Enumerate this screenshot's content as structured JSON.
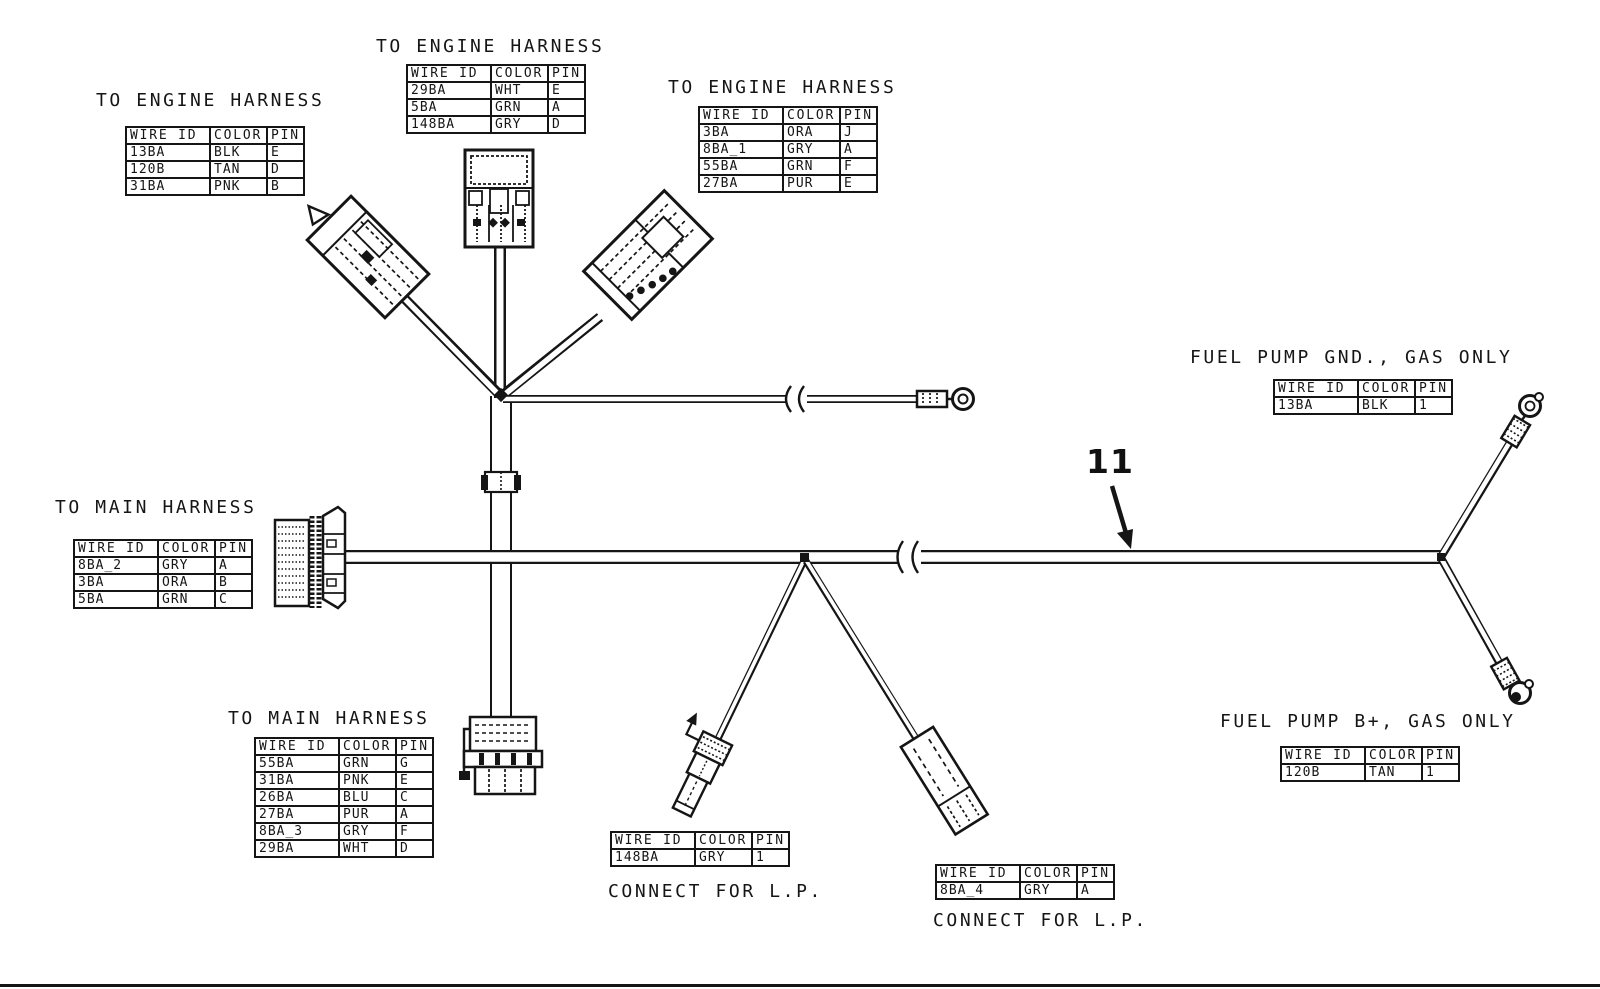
{
  "diagram": {
    "table_headers": [
      "WIRE ID",
      "COLOR",
      "PIN"
    ],
    "tables": [
      {
        "id": "engine-harness-top-left",
        "title": "TO ENGINE HARNESS",
        "rows": [
          [
            "13BA",
            "BLK",
            "E"
          ],
          [
            "120B",
            "TAN",
            "D"
          ],
          [
            "31BA",
            "PNK",
            "B"
          ]
        ]
      },
      {
        "id": "engine-harness-top-center",
        "title": "TO ENGINE HARNESS",
        "rows": [
          [
            "29BA",
            "WHT",
            "E"
          ],
          [
            "5BA",
            "GRN",
            "A"
          ],
          [
            "148BA",
            "GRY",
            "D"
          ]
        ]
      },
      {
        "id": "engine-harness-top-right",
        "title": "TO ENGINE HARNESS",
        "rows": [
          [
            "3BA",
            "ORA",
            "J"
          ],
          [
            "8BA_1",
            "GRY",
            "A"
          ],
          [
            "55BA",
            "GRN",
            "F"
          ],
          [
            "27BA",
            "PUR",
            "E"
          ]
        ]
      },
      {
        "id": "main-harness-left",
        "title": "TO MAIN HARNESS",
        "rows": [
          [
            "8BA_2",
            "GRY",
            "A"
          ],
          [
            "3BA",
            "ORA",
            "B"
          ],
          [
            "5BA",
            "GRN",
            "C"
          ]
        ]
      },
      {
        "id": "main-harness-bottom",
        "title": "TO MAIN HARNESS",
        "rows": [
          [
            "55BA",
            "GRN",
            "G"
          ],
          [
            "31BA",
            "PNK",
            "E"
          ],
          [
            "26BA",
            "BLU",
            "C"
          ],
          [
            "27BA",
            "PUR",
            "A"
          ],
          [
            "8BA_3",
            "GRY",
            "F"
          ],
          [
            "29BA",
            "WHT",
            "D"
          ]
        ]
      },
      {
        "id": "fuel-pump-gnd",
        "title": "FUEL PUMP GND., GAS ONLY",
        "rows": [
          [
            "13BA",
            "BLK",
            "1"
          ]
        ]
      },
      {
        "id": "fuel-pump-b-plus",
        "title": "FUEL PUMP B+, GAS ONLY",
        "rows": [
          [
            "120B",
            "TAN",
            "1"
          ]
        ]
      },
      {
        "id": "connect-for-lp-left",
        "title": "CONNECT FOR L.P.",
        "rows": [
          [
            "148BA",
            "GRY",
            "1"
          ]
        ]
      },
      {
        "id": "connect-for-lp-right",
        "title": "CONNECT FOR L.P.",
        "rows": [
          [
            "8BA_4",
            "GRY",
            "A"
          ]
        ]
      }
    ],
    "callout": {
      "label": "11"
    },
    "colors": {
      "ink": "#151515",
      "paper": "#ffffff"
    }
  }
}
